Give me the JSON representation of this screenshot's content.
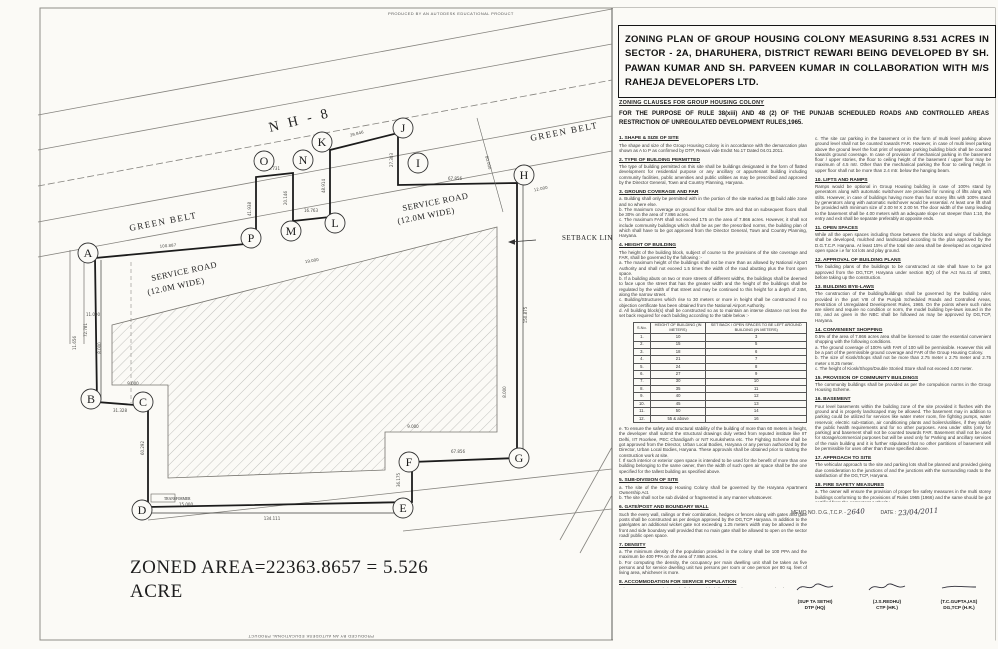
{
  "stamps": {
    "autodesk": "PRODUCED BY AN AUTODESK EDUCATIONAL PRODUCT"
  },
  "title_block": {
    "text": "ZONING PLAN OF GROUP HOUSING COLONY MEASURING 8.531 ACRES IN SECTOR - 2A, DHARUHERA, DISTRICT REWARI  BEING DEVELOPED BY SH. PAWAN KUMAR AND SH. PARVEEN KUMAR IN COLLABORATION WITH M/S RAHEJA DEVELOPERS LTD."
  },
  "clauses_header": "ZONING CLAUSES FOR GROUP HOUSING COLONY",
  "purpose": "FOR THE PURPOSE OF RULE 38(xiii) AND 48 (2) OF THE PUNJAB SCHEDULED ROADS  AND CONTROLLED AREAS RESTRICTION OF UNREGULATED DEVELOPMENT RULES,1965.",
  "clauses_left": [
    {
      "no": "1.",
      "heading": "SHAPE & SIZE OF SITE",
      "body": "The shape and size of the Group Housing Colony is in accordance with the demarcation plan shown as A to P as confirmed by DTP, Rewari vide Endst No.17 Dated 04.01.2011."
    },
    {
      "no": "2.",
      "heading": "TYPE OF BUILDING PERMITTED",
      "body": "The type of building permitted on this site shall be buildings designated in the form of flatted development for residential purpose or any ancillary or appurtenant building including community facilities, public amenities and public utilities as may be prescribed and approved by the Director General, Town and Country Planning, Haryana."
    },
    {
      "no": "3.",
      "heading": "GROUND COVERAGE AND FAR",
      "body": "a. Building shall only be permitted with in the portion of the site marked as ▨ build able zone and no where else.\nb. The maximum coverage on ground floor shall be 35% and that on subsequent floors shall be 30% on the area of 7.866 acres.\nc. The maximum FAR shall not exceed 175 on the area of 7.866 acres. However, it shall not include community buildings which shall be as per the prescribed norms, the building plan of which shall have to be got approved from the Director General, Town and Country Planning, Haryana."
    },
    {
      "no": "4.",
      "heading": "HEIGHT OF BUILDING",
      "body": "The height of the building block, subject of course to the provisions of the site coverage and FAR, shall be governed by the following :-\na. The maximum height of the buildings shall not be more than as allowed by National Airport Authority and shall not exceed 1.5 times the width of the road abutting plus the front open space.\nb. If a building abuts on two or more streets of different widths, the buildings shall be deemed to face upon the street that has the greater width and the height of the buildings shall be regulated by the width of that street and may be continued to this height for a depth of 24M, along the narrow street.\nc. Building/Structures which rise to 30 meters or more in height shall be constructed if no objection certificate has been obtained from the National Airport Authority.\nd. All building block(s) shall be constructed so as to maintain an interse distance not less the set back required for each building according to the table below :-",
      "table": "height_table",
      "body2": "e. To ensure the safety and structural stability of the building of more than 60 meters in height, the developer shall submit the structural drawings duly vetted from reputed institute like IIT Delhi, IIT Roorkee, PEC Chandigarh or NIT Kurukshetra etc. The Fighting Scheme shall be got approved from the Director, Urban Local Bodies, Haryana or any person authorized by the Director, Urban Local Bodies, Haryana. These approvals shall be obtained prior to starting the construction work at site.\nf. If such interior or exterior open space is intended to be used for the benefit of more than one building belonging to the same owner, then the width of such open air space shall be the one specified for the tallest building as specified above."
    },
    {
      "no": "5.",
      "heading": "SUB-DIVISION OF SITE",
      "body": "a. The site of the Group Housing Colony shall be governed by the Haryana Apartment Ownership Act.\nb. The site shall not be sub divided or fragmented in any manner whatsoever."
    },
    {
      "no": "6.",
      "heading": "GATE/POST AND BOUNDARY WALL",
      "body": "Such the every wall, railings or their combination, hedges or fences along with gates and gate posts shall be constructed as per design approved by the DG,TCP Haryana. In addition to the gate/gates an additional wicket gate not exceeding 1.25 meters width may be allowed in the front and side boundary wall provided that no main gate shall be allowed to open on the sector road/ public open space."
    },
    {
      "no": "7.",
      "heading": "DENSITY",
      "body": "a. The minimum density of the population provided in the colony shall be 100 PPA and the maximum be 400 PPA on the area of 7.866 acres.\nb. For computing the density, the occupancy per main dwelling unit shall be taken as five persons and for service dwelling unit two persons per room or one person per 80 sq. feet of living area, whichever is more."
    },
    {
      "no": "8.",
      "heading": "ACCOMMODATION FOR SERVICE POPULATION",
      "body": "Adequate accommodation shall be provided for domestic servants and other service population of EWS/LIG either of such dwelling units for 10% of the number of main dwelling units and the carpet area of such a unit if attached to the main units shall not be less than 140 sq.ft. In addition 15% of the total number of dwelling units having a minimum area of 200 sq.ft shall be earmarked for EWS category."
    },
    {
      "no": "9.",
      "heading": "PARKING",
      "body": "a. Parking space shall be provided @ 1.5 Equivalent Car Space for each dwelling unit. These parking spaces shall be allotted only to the flat holders and shall not be allotted, leased, sold or transferred to any channel by the third party. The area for parking per car shall be as under :-\n      i)  Basement:  35 sqm.\n      ii)  Stilts:       30 sqm.\n      iii) Open:      25 sqm.\nb. At least 75% of the equivalent car spaces shall be provided in the form of covered parking further minimum 5% of the total parking will be made available to the Park-Category flats."
    }
  ],
  "clauses_right": [
    {
      "no": "",
      "heading": "",
      "body": "c. The site car parking in the basement or in the form of multi level parking above ground level shall not be counted towards FAR. However, in case of multi level parking above the ground level the foot print of separate parking building block shall be counted towards ground coverage. In case of provision of mechanical parking in the basement floor / upper stories, the floor to ceiling height of the basement / upper floor may be maximum of 4.5 mtr. Other than the mechanical parking the floor to ceiling height in upper floor shall not be more than 2.4 mtr. below the hanging beam."
    },
    {
      "no": "10.",
      "heading": "LIFTS AND RAMPS",
      "body": "Ramps would be optional in Group Housing building in case of 100% stand by generators along with automatic switchover are provided for running of lifts along with stilts. However, in case of buildings having more than four storey lifts with 100% stand by generators along with automatic switchover would be essential. At least one lift shall be provided with minimum size of 2.00 M X 2.00 M. The door width of the ramp leading to the basement shall be 4.00 meters with an adequate slope not steeper than 1:10, the entry and exit shall be separate preferably at opposite ends."
    },
    {
      "no": "11.",
      "heading": "OPEN SPACES",
      "body": "While all the open spaces including those between the blocks and wings of buildings shall be developed, mulched and landscaped according to the plan approved by the D.G.T.C.P. Haryana. At least 15% of the total site area shall be developed as organized open space i.e for tot lots and play ground."
    },
    {
      "no": "12.",
      "heading": "APPROVAL OF BUILDING PLANS",
      "body": "The building plans of the buildings to be constructed at site shall have to be got approved from the DG,TCP, Haryana under section 8(2) of the Act No.41 of 1963, before taking up the construction."
    },
    {
      "no": "13.",
      "heading": "BUILDING BYE-LAWS",
      "body": "The construction of the building/buildings shall be governed by the building rules provided in the part VIII of the Punjab Scheduled Roads and Controlled Areas, Restriction of Unregulated Development Rules, 1965. On the points where such rules are silent and require no condition or norm, the model building bye-laws issued in the ISI, and as given in the NBC shall be followed as may be approved by DG,TCP, Haryana."
    },
    {
      "no": "14.",
      "heading": "CONVENIENT SHOPPING",
      "body": "0.5% of the area of 7.866 acres area shall be licensed to cater the essential convenient shopping with the following conditions.\na. The ground coverage of 100% with FAR of 100 will be permissible. However this will be a part of the permissible ground coverage and FAR of the Group Housing Colony.\nb. The size of Kiosk/Shops shall not be more than 2.75 meter x 2.75 meter and 2.75 meter x 8.25 meter.\nc. The height of Kiosk/Shops/Double Storied Store shall not exceed 4.00 meter."
    },
    {
      "no": "15.",
      "heading": "PROVISION OF COMMUNITY BUILDINGS",
      "body": "The community buildings shall be provided as per the compulsion norms in the Group Housing Scheme."
    },
    {
      "no": "16.",
      "heading": "BASEMENT",
      "body": "Four level basements within the building zone of the site provided it flushes with the ground and is properly landscaped may be allowed. The basement may in addition to parking could be utilized for services like water meter room, fire fighting pumps, water reservoir, electric sub-station, air conditioning plants and boilers/utilities, if they satisfy the public health requirements and for no other purposes. Area under stilts (only for parking) and basement shall not be counted towards FAR. Basement shall not be used for storage/commercial purposes but will be used only for Parking and ancillary services of the main building and it is further stipulated that no other partitions of basement will be permissible for uses other than those specified above."
    },
    {
      "no": "17.",
      "heading": "APPROACH TO SITE",
      "body": "The vehicular approach to the site and parking lots shall be planned and provided giving due consideration to the junctions of and the junctions with the surrounding roads to the satisfaction of the DG,TCP, Haryana."
    },
    {
      "no": "18.",
      "heading": "FIRE SAFETY MEASURES",
      "body": "a. The owner will ensure the provision of proper fire safety measures in the multi storey buildings conforming to the provisions of Rules 1965 (1966) and the same should be got certified from the competent Authority.\nb. Electric Sub Station / generator room if provided should be on total ground floor, DG/LT. Control panel on ground floor or in upper basement and it should be located on outer periphery of the building, the same should be got approved from the competent authority."
    },
    {
      "no": "19.",
      "heading": "SOLAR WATER HEATING SYSTEM",
      "body": "The provision of solar water heating system shall be as per norms specified by HAREDA and shall be made operational in each building block before applying for an occupation certificate."
    },
    {
      "no": "20.",
      "heading": "RAIN WATER HARVESTING SYSTEM",
      "body": "The rain water harvesting system shall be provided as per Central Ground Water Authority norms/Haryana Govt. notification as applicable."
    },
    {
      "no": "21.",
      "heading": "",
      "body": "The colonizer shall obtain the clearance/NOC as per the provisions of the Notification No. S.O. 1533(E) dated 14.9.2006 issued by Ministry of Environment and Forest, Government of India before starting the construction/execution of development work at site."
    },
    {
      "no": "22.",
      "heading": "",
      "body": "The colonizer/owner shall use only Compact Fluorescent Lamps fittings for internal lighting as well as campus lighting."
    },
    {
      "no": "23.",
      "heading": "",
      "body": "The site reserved for community use, earmarked within a Group Housing Colony: the community buildings shall be constructed within a period of three years. The time period of three years shall start from the date of issuance of sanction letter of the zoning plan, in case of failure to do so within such time period, the Government may take over the community site in accordance with the provisions of Section 8(8) of the Act no 8 of 1975."
    }
  ],
  "height_table": {
    "headers": [
      "S.No.",
      "HEIGHT OF BUILDING (IN METERS)",
      "SET BACK / OPEN SPACES TO BE LEFT AROUND BUILDING (IN METERS)"
    ],
    "rows": [
      [
        "1.",
        "10",
        "3"
      ],
      [
        "2.",
        "15",
        "5"
      ],
      [
        "3.",
        "18",
        "6"
      ],
      [
        "4.",
        "21",
        "7"
      ],
      [
        "5.",
        "24",
        "8"
      ],
      [
        "6.",
        "27",
        "9"
      ],
      [
        "7.",
        "30",
        "10"
      ],
      [
        "8.",
        "35",
        "11"
      ],
      [
        "9.",
        "40",
        "12"
      ],
      [
        "10.",
        "45",
        "13"
      ],
      [
        "11.",
        "50",
        "14"
      ],
      [
        "12.",
        "55 & above",
        "16"
      ]
    ]
  },
  "memo": {
    "label": "MEMO NO. D.G.,T.C.P. -",
    "number": "2640",
    "date_label": "DATE :",
    "date": "23/04/2011"
  },
  "signatures": [
    {
      "name": "(SUP TA SETHI)",
      "title": "DTP (HQ)"
    },
    {
      "name": "(J.S.REDHU)",
      "title": "CTP (HR.)"
    },
    {
      "name": "(T.C.GUPTA,IAS)",
      "title": "DG,TCP (H.R.)"
    }
  ],
  "plan": {
    "zoned_area": "ZONED  AREA=22363.8657 =  5.526\nACRE",
    "labels": [
      {
        "t": "N H - 8",
        "x": 270,
        "y": 132,
        "r": -14,
        "s": 14,
        "sp": 3
      },
      {
        "t": "GREEN BELT",
        "x": 130,
        "y": 231,
        "r": -11,
        "s": 9,
        "sp": 1.5
      },
      {
        "t": "GREEN BELT",
        "x": 531,
        "y": 141,
        "r": -11,
        "s": 9,
        "sp": 1.5
      },
      {
        "t": "SERVICE ROAD",
        "x": 152,
        "y": 281,
        "r": -12,
        "s": 8.5,
        "sp": 0.5
      },
      {
        "t": "(12.0M WIDE)",
        "x": 148,
        "y": 295,
        "r": -12,
        "s": 8.5,
        "sp": 0.5
      },
      {
        "t": "SERVICE ROAD",
        "x": 403,
        "y": 211,
        "r": -11,
        "s": 8.5,
        "sp": 0.5
      },
      {
        "t": "(12.0M WIDE)",
        "x": 398,
        "y": 224,
        "r": -11,
        "s": 8.5,
        "sp": 0.5
      },
      {
        "t": "SETBACK LINE",
        "x": 562,
        "y": 240,
        "r": 0,
        "s": 7,
        "sp": 0.5
      },
      {
        "t": "TRANSFORMER",
        "x": 164,
        "y": 500,
        "r": 0,
        "s": 3.6,
        "sp": 0
      }
    ],
    "vertices": [
      {
        "l": "A",
        "x": 88,
        "y": 253
      },
      {
        "l": "B",
        "x": 91,
        "y": 399
      },
      {
        "l": "C",
        "x": 143,
        "y": 402
      },
      {
        "l": "D",
        "x": 142,
        "y": 510
      },
      {
        "l": "E",
        "x": 403,
        "y": 508
      },
      {
        "l": "F",
        "x": 409,
        "y": 462
      },
      {
        "l": "G",
        "x": 519,
        "y": 458
      },
      {
        "l": "H",
        "x": 524,
        "y": 175
      },
      {
        "l": "I",
        "x": 418,
        "y": 163
      },
      {
        "l": "J",
        "x": 403,
        "y": 128
      },
      {
        "l": "K",
        "x": 322,
        "y": 142
      },
      {
        "l": "L",
        "x": 335,
        "y": 223
      },
      {
        "l": "M",
        "x": 291,
        "y": 231
      },
      {
        "l": "N",
        "x": 303,
        "y": 160
      },
      {
        "l": "O",
        "x": 264,
        "y": 161
      },
      {
        "l": "P",
        "x": 251,
        "y": 238
      }
    ],
    "dimensions": [
      {
        "t": "100.887",
        "x": 168,
        "y": 247,
        "r": -5
      },
      {
        "t": "41.938",
        "x": 251,
        "y": 209,
        "r": -90
      },
      {
        "t": "11.731",
        "x": 273,
        "y": 170,
        "r": 0
      },
      {
        "t": "20.146",
        "x": 287,
        "y": 198,
        "r": -90
      },
      {
        "t": "16.763",
        "x": 311,
        "y": 212,
        "r": 0
      },
      {
        "t": "48.914",
        "x": 325,
        "y": 186,
        "r": -90
      },
      {
        "t": "39.846",
        "x": 357,
        "y": 135,
        "r": -14
      },
      {
        "t": "27.303",
        "x": 393,
        "y": 160,
        "r": -90
      },
      {
        "t": "67.856",
        "x": 455,
        "y": 180,
        "r": 0
      },
      {
        "t": "80.000",
        "x": 487,
        "y": 163,
        "r": 75
      },
      {
        "t": "12.000",
        "x": 541,
        "y": 190,
        "r": -12
      },
      {
        "t": "19.000",
        "x": 312,
        "y": 262,
        "r": -10
      },
      {
        "t": "150.875",
        "x": 527,
        "y": 315,
        "r": -90
      },
      {
        "t": "8.000",
        "x": 506,
        "y": 392,
        "r": -90
      },
      {
        "t": "9.000",
        "x": 413,
        "y": 428,
        "r": 0
      },
      {
        "t": "67.856",
        "x": 458,
        "y": 453,
        "r": 0
      },
      {
        "t": "36.175",
        "x": 400,
        "y": 480,
        "r": -90
      },
      {
        "t": "134.111",
        "x": 272,
        "y": 520,
        "r": 0
      },
      {
        "t": "15.000",
        "x": 186,
        "y": 506,
        "r": 0
      },
      {
        "t": "60.292",
        "x": 144,
        "y": 448,
        "r": -90
      },
      {
        "t": "31.328",
        "x": 120,
        "y": 412,
        "r": 0
      },
      {
        "t": "9.000",
        "x": 133,
        "y": 385,
        "r": 0
      },
      {
        "t": "8.000",
        "x": 101,
        "y": 348,
        "r": -90
      },
      {
        "t": "72.781",
        "x": 87,
        "y": 330,
        "r": -90
      },
      {
        "t": "11.000",
        "x": 93,
        "y": 316,
        "r": 0
      },
      {
        "t": "11.656",
        "x": 76,
        "y": 343,
        "r": -90
      }
    ]
  }
}
